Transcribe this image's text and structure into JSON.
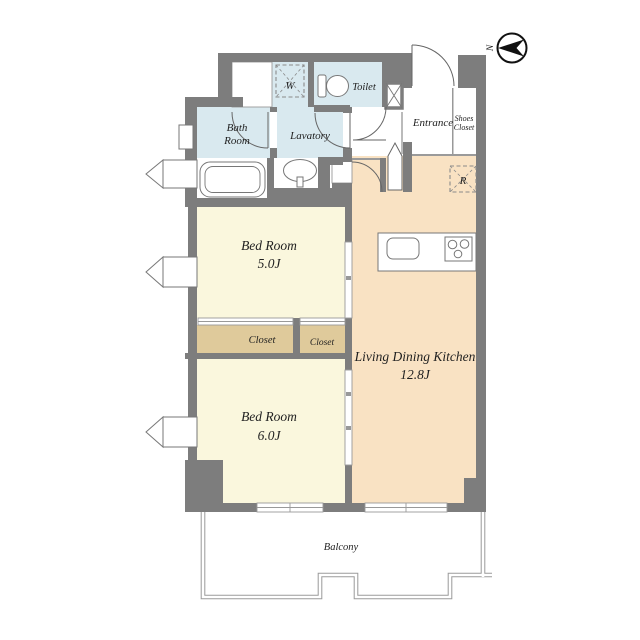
{
  "plan_title": "apartment-floor-plan",
  "colors": {
    "wall": "#7d7d7d",
    "wet_room": "#d9e9ef",
    "bedroom": "#faf7dd",
    "ldk": "#f9e2c3",
    "closet": "#dfca9b",
    "white": "#ffffff",
    "outline": "#777777",
    "balcony_line": "#999999",
    "text": "#1f1f1f"
  },
  "rooms": {
    "bath_room": {
      "line1": "Bath",
      "line2": "Room"
    },
    "lavatory": {
      "label": "Lavatory"
    },
    "toilet": {
      "label": "Toilet"
    },
    "entrance": {
      "label": "Entrance"
    },
    "shoes_closet": {
      "line1": "Shoes",
      "line2": "Closet"
    },
    "bedroom_5": {
      "label": "Bed Room",
      "size": "5.0J"
    },
    "bedroom_6": {
      "label": "Bed Room",
      "size": "6.0J"
    },
    "ldk": {
      "label": "Living Dining Kitchen",
      "size": "12.8J"
    },
    "closet_main": {
      "label": "Closet"
    },
    "closet_small": {
      "label": "Closet"
    },
    "balcony": {
      "label": "Balcony"
    }
  },
  "symbols": {
    "washer_space": "W",
    "refrigerator_space": "R",
    "north": "N"
  }
}
